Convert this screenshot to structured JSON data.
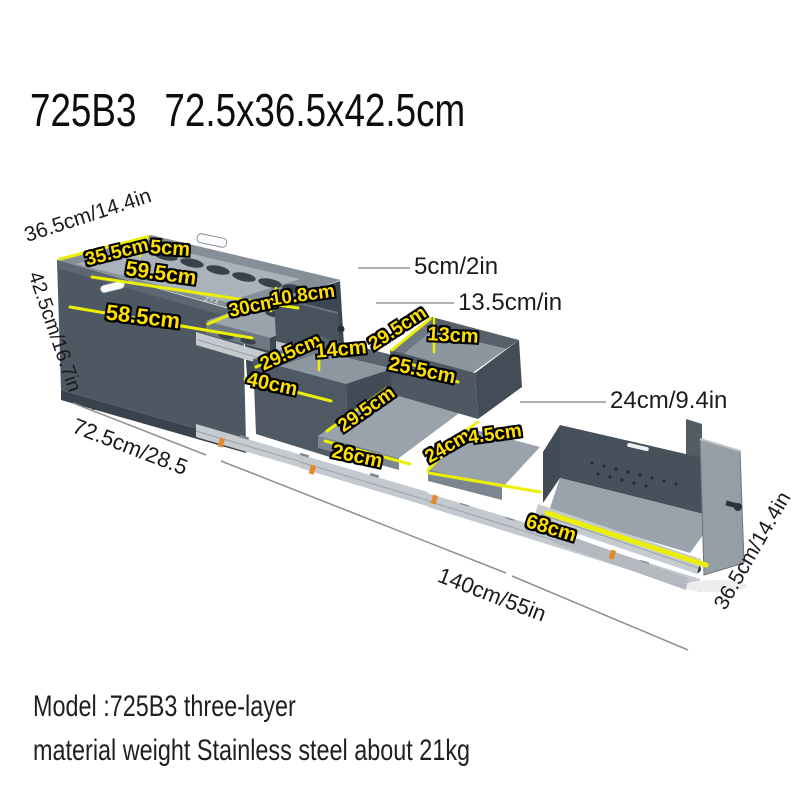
{
  "title": {
    "model": "725B3",
    "dimensions": "72.5x36.5x42.5cm"
  },
  "product": {
    "brand_logo": "ZYX"
  },
  "footer": {
    "line1": "Model :725B3 three-layer",
    "line2": "material weight Stainless steel about 21kg"
  },
  "colors": {
    "annotation_yellow": "#ffdf00",
    "dimension_line_yellow": "#ebf000",
    "box_body_gray": "#4e5862",
    "leader_line_gray": "#999999"
  },
  "annotations": {
    "yellow_labels": [
      {
        "text": "35.5cm",
        "x": 117,
        "y": 253,
        "rot": -14,
        "size": 19
      },
      {
        "text": "5cm",
        "x": 170,
        "y": 249,
        "rot": 4,
        "size": 20
      },
      {
        "text": "59.5cm",
        "x": 161,
        "y": 274,
        "rot": 8,
        "size": 21
      },
      {
        "text": "58.5cm",
        "x": 143,
        "y": 317,
        "rot": 7,
        "size": 22
      },
      {
        "text": "30cm",
        "x": 253,
        "y": 307,
        "rot": -12,
        "size": 19
      },
      {
        "text": "10.8cm",
        "x": 303,
        "y": 296,
        "rot": -8,
        "size": 19
      },
      {
        "text": "29.5cm",
        "x": 291,
        "y": 353,
        "rot": -24,
        "size": 19
      },
      {
        "text": "14cm",
        "x": 341,
        "y": 350,
        "rot": -5,
        "size": 20
      },
      {
        "text": "40cm",
        "x": 272,
        "y": 385,
        "rot": 12,
        "size": 20
      },
      {
        "text": "29.5cm",
        "x": 367,
        "y": 410,
        "rot": -35,
        "size": 19
      },
      {
        "text": "26cm",
        "x": 357,
        "y": 457,
        "rot": 12,
        "size": 20
      },
      {
        "text": "29.5cm",
        "x": 398,
        "y": 329,
        "rot": -33,
        "size": 19
      },
      {
        "text": "13cm",
        "x": 453,
        "y": 336,
        "rot": 3,
        "size": 20
      },
      {
        "text": "25.5cm",
        "x": 422,
        "y": 371,
        "rot": 12,
        "size": 20
      },
      {
        "text": "24cm",
        "x": 448,
        "y": 447,
        "rot": -30,
        "size": 19
      },
      {
        "text": "4.5cm",
        "x": 495,
        "y": 435,
        "rot": -8,
        "size": 19
      },
      {
        "text": "68cm",
        "x": 551,
        "y": 529,
        "rot": 17,
        "size": 20
      }
    ],
    "black_labels": [
      {
        "text": "36.5cm/14.4in",
        "x": 88,
        "y": 216,
        "rot": -18,
        "size": 21
      },
      {
        "text": "42.5cm/16.7in",
        "x": 54,
        "y": 332,
        "rot": 71,
        "size": 20
      },
      {
        "text": "72.5cm/28.5",
        "x": 130,
        "y": 447,
        "rot": 21,
        "size": 22
      },
      {
        "text": "140cm/55in",
        "x": 492,
        "y": 595,
        "rot": 21,
        "size": 22
      },
      {
        "text": "36.5cm/14.4in",
        "x": 753,
        "y": 551,
        "rot": -60,
        "size": 21
      }
    ],
    "callout_labels": [
      {
        "text": "5cm/2in",
        "x": 414,
        "y": 267
      },
      {
        "text": "13.5cm/in",
        "x": 458,
        "y": 303
      },
      {
        "text": "24cm/9.4in",
        "x": 610,
        "y": 401
      }
    ]
  }
}
